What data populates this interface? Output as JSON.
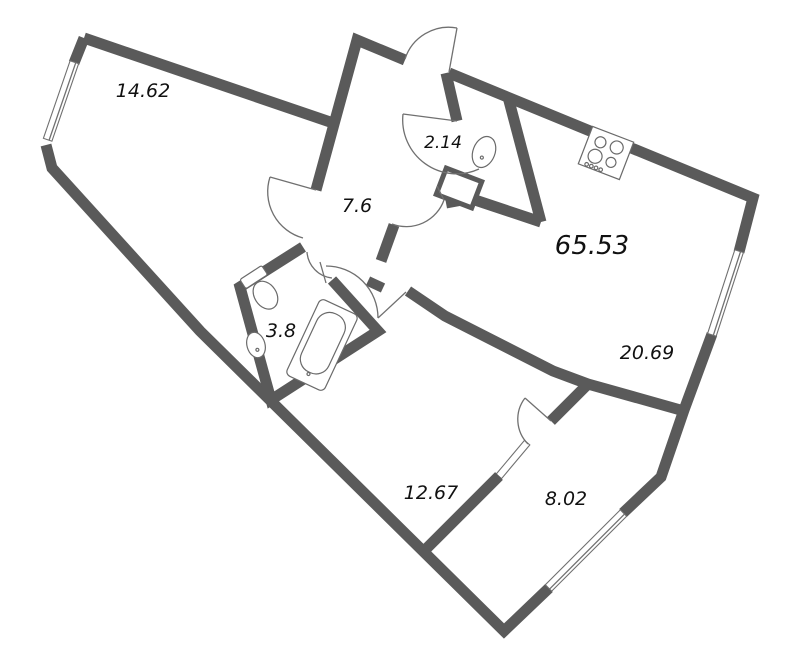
{
  "plan": {
    "type": "apartment-floor-plan",
    "rooms": {
      "bedroom": {
        "area_label": "14.62"
      },
      "wc": {
        "area_label": "2.14"
      },
      "hallway": {
        "area_label": "7.6"
      },
      "total_area": {
        "area_label": "65.53"
      },
      "living_room": {
        "area_label": "20.69"
      },
      "bathroom": {
        "area_label": "3.8"
      },
      "corridor": {
        "area_label": "12.67"
      },
      "balcony": {
        "area_label": "8.02"
      }
    },
    "fixtures": [
      "stove-icon",
      "wc-sink-icon",
      "toilet-icon",
      "bathroom-sink-icon",
      "bathtub-icon"
    ],
    "colors": {
      "wall": "#5a5a5a",
      "thin_line": "#707070",
      "text": "#111111",
      "background": "#ffffff"
    }
  }
}
